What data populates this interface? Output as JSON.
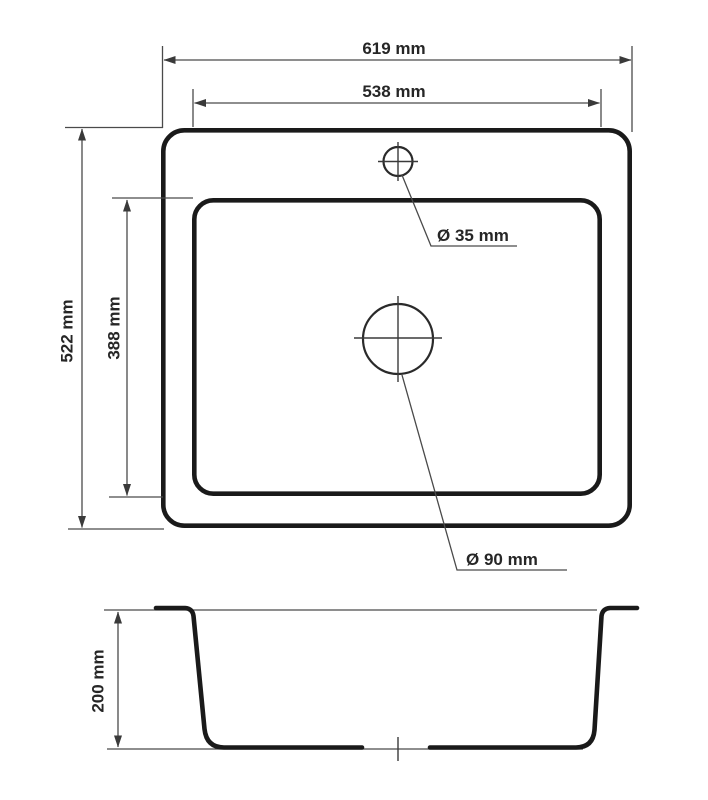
{
  "drawing": {
    "type": "sink-technical-drawing",
    "units": "mm",
    "views": [
      "top-view",
      "section-view"
    ],
    "labels": {
      "outer_width": "619 mm",
      "inner_width": "538 mm",
      "outer_depth": "522 mm",
      "inner_depth": "388 mm",
      "faucet_hole_diameter": "Ø 35 mm",
      "drain_hole_diameter": "Ø 90 mm",
      "bowl_depth": "200 mm"
    },
    "values_mm": {
      "outer_width": 619,
      "inner_width": 538,
      "outer_depth": 522,
      "inner_depth": 388,
      "faucet_hole_diameter": 35,
      "drain_hole_diameter": 90,
      "bowl_depth": 200
    },
    "colors": {
      "background": "#ffffff",
      "outline": "#1a1a1a",
      "dimension_line": "#4a4a4a",
      "text": "#262626"
    }
  }
}
